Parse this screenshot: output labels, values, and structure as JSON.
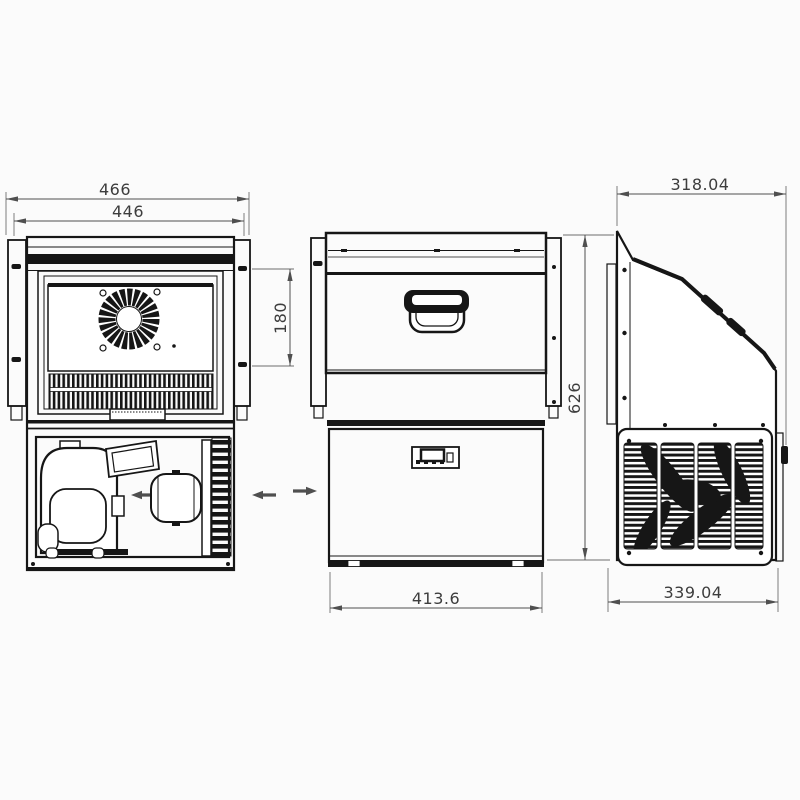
{
  "colors": {
    "background": "#fbfbfb",
    "line": "#161616",
    "dimension_line": "#4f4f4f",
    "dimension_text": "#3d3d3d"
  },
  "dimensions": {
    "rear_outer_width": "466",
    "rear_inner_width": "446",
    "rear_vent_height": "180",
    "front_width": "413.6",
    "overall_height": "626",
    "side_top_depth": "318.04",
    "side_bottom_depth": "339.04"
  }
}
